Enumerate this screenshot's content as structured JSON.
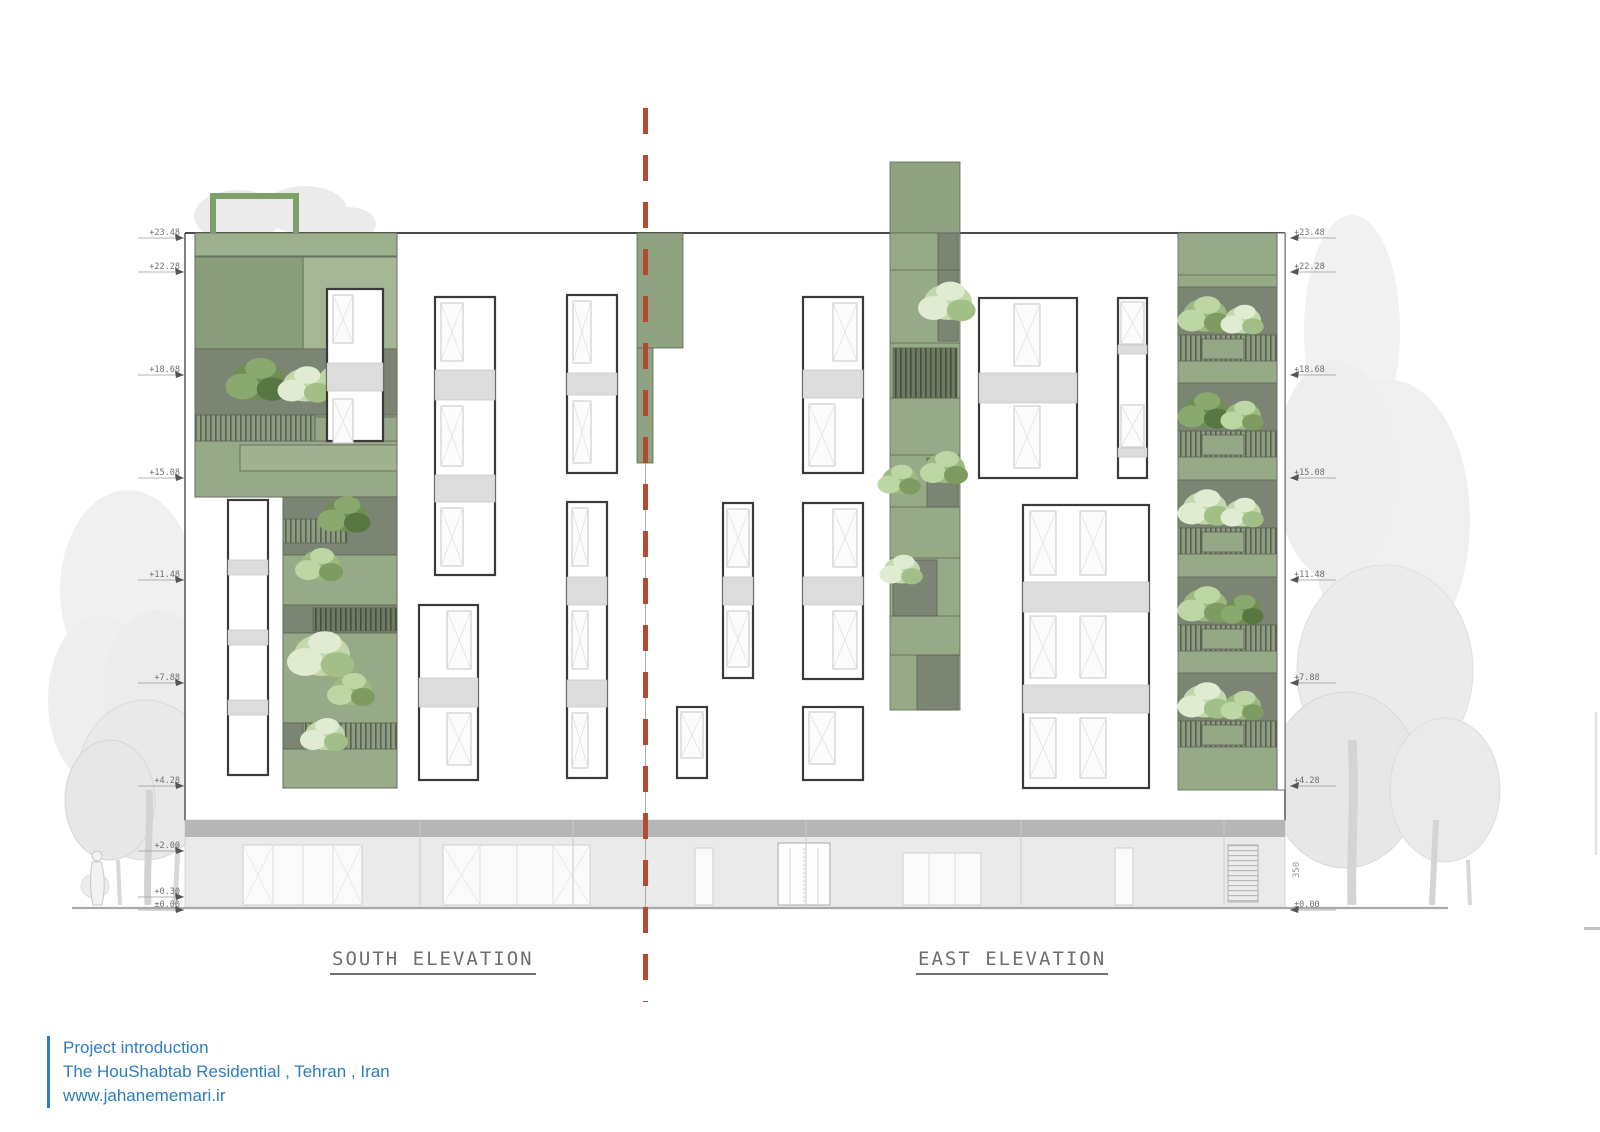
{
  "titles": {
    "south": "SOUTH ELEVATION",
    "east": "EAST ELEVATION"
  },
  "levels": {
    "left": [
      {
        "label": "+23.48",
        "y": 238
      },
      {
        "label": "+22.28",
        "y": 272
      },
      {
        "label": "+18.68",
        "y": 375
      },
      {
        "label": "+15.08",
        "y": 478
      },
      {
        "label": "+11.48",
        "y": 580
      },
      {
        "label": "+7.88",
        "y": 683
      },
      {
        "label": "+4.28",
        "y": 786
      },
      {
        "label": "+2.00",
        "y": 851
      },
      {
        "label": "+0.30",
        "y": 897
      },
      {
        "label": "±0.00",
        "y": 910
      }
    ],
    "right": [
      {
        "label": "+23.48",
        "y": 238
      },
      {
        "label": "+22.28",
        "y": 272
      },
      {
        "label": "+18.68",
        "y": 375
      },
      {
        "label": "+15.08",
        "y": 478
      },
      {
        "label": "+11.48",
        "y": 580
      },
      {
        "label": "+7.88",
        "y": 683
      },
      {
        "label": "+4.28",
        "y": 786
      },
      {
        "label": "±0.00",
        "y": 910
      }
    ]
  },
  "dimensions": {
    "right_vertical": "350"
  },
  "footer": {
    "line1": "Project introduction",
    "line2": "The HouShabtab Residential , Tehran , Iran",
    "line3": "www.jahanememari.ir"
  },
  "colors": {
    "accent_blue": "#2e7cc0",
    "section_line_red": "#b44a32",
    "facade_green": "#97aa88",
    "terrace_gray_green": "#7c8573",
    "spandrel_gray": "#dcdcdc",
    "ground_floor_gray": "#eaeaea"
  }
}
